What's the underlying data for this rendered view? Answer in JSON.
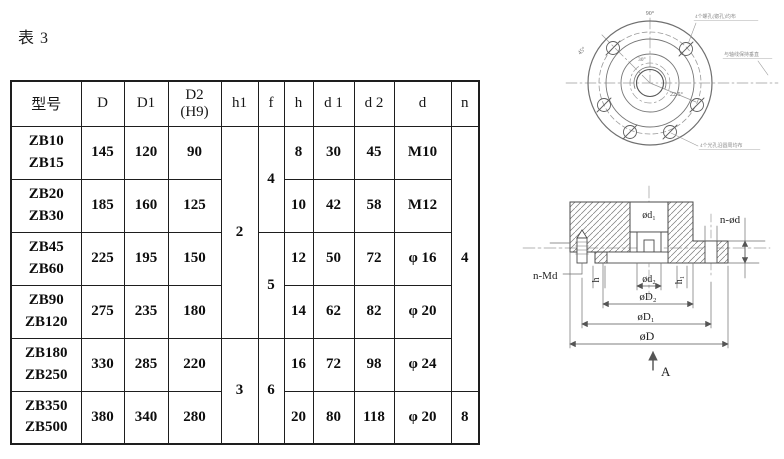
{
  "page": {
    "title": "表 3"
  },
  "table": {
    "header": {
      "model": "型号",
      "D": "D",
      "D1": "D1",
      "D2": "D2",
      "D2_sub": "(H9)",
      "h1": "h1",
      "f": "f",
      "h": "h",
      "d1": "d 1",
      "d2": "d 2",
      "d": "d",
      "n": "n"
    },
    "rows": [
      {
        "model1": "ZB10",
        "model2": "ZB15",
        "D": "145",
        "D1": "120",
        "D2": "90",
        "h": "8",
        "d1": "30",
        "d2": "45",
        "d": "M10"
      },
      {
        "model1": "ZB20",
        "model2": "ZB30",
        "D": "185",
        "D1": "160",
        "D2": "125",
        "h": "10",
        "d1": "42",
        "d2": "58",
        "d": "M12"
      },
      {
        "model1": "ZB45",
        "model2": "ZB60",
        "D": "225",
        "D1": "195",
        "D2": "150",
        "h": "12",
        "d1": "50",
        "d2": "72",
        "d": "φ 16"
      },
      {
        "model1": "ZB90",
        "model2": "ZB120",
        "D": "275",
        "D1": "235",
        "D2": "180",
        "h": "14",
        "d1": "62",
        "d2": "82",
        "d": "φ 20"
      },
      {
        "model1": "ZB180",
        "model2": "ZB250",
        "D": "330",
        "D1": "285",
        "D2": "220",
        "h": "16",
        "d1": "72",
        "d2": "98",
        "d": "φ 24"
      },
      {
        "model1": "ZB350",
        "model2": "ZB500",
        "D": "380",
        "D1": "340",
        "D2": "280",
        "h": "20",
        "d1": "80",
        "d2": "118",
        "d": "φ 20"
      }
    ],
    "merged": {
      "h1_top": "2",
      "h1_bottom": "3",
      "f_1": "4",
      "f_2": "5",
      "f_3": "6",
      "n_top": "4",
      "n_bottom": "8"
    }
  },
  "drawings": {
    "front_view": {
      "angle_labels": {
        "a90": "90°",
        "a45": "45°",
        "a30": "30°",
        "a225": "22.5°"
      },
      "annotations": {
        "top": "4个螺孔(锪孔)均布",
        "right": "与轴线保持垂直",
        "bottom": "4个光孔沿圆周均布"
      }
    },
    "section_view": {
      "labels": {
        "bore": "ød₁",
        "holes": "n-ød",
        "tapped": "n-Md",
        "h": "h",
        "d2": "ød₂",
        "h1": "h₁",
        "D2": "øD₂",
        "D1": "øD₁",
        "D": "øD",
        "view": "A"
      }
    }
  }
}
